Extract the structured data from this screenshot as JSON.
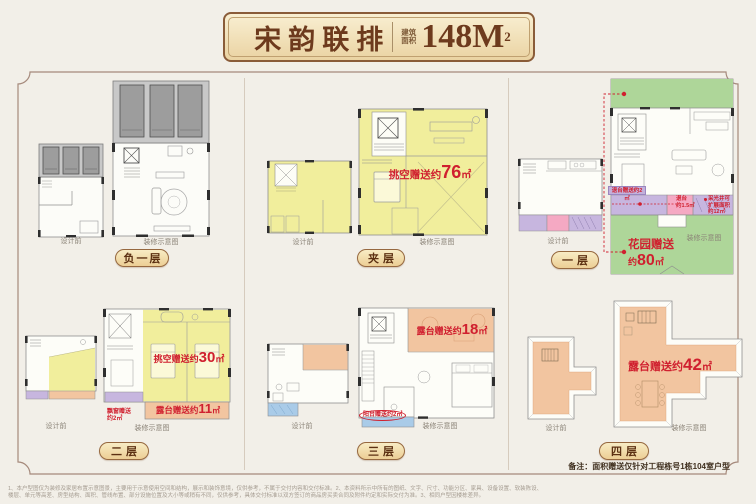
{
  "colors": {
    "background": "#f2efe8",
    "accent_red": "#d0202f",
    "badge_gold": "#ecce95",
    "badge_border": "#96683f",
    "frame_border": "#a5897b",
    "yellow_area": "#f1ee9c",
    "green_area": "#aed699",
    "orange_area": "#f2c5a0",
    "purple_area": "#c7b6df",
    "pink_area": "#f5a9c3",
    "blue_area": "#a9cbe8"
  },
  "title": {
    "name": "宋韵联排",
    "area_label": "建筑面积",
    "area_number": "148M",
    "area_sup": "2"
  },
  "plan_labels": {
    "before": "设计前",
    "after": "装修示意图"
  },
  "floors": {
    "b1": {
      "name": "负一层"
    },
    "mezz": {
      "name": "夹层",
      "void_gift": {
        "prefix": "挑空赠送约",
        "value": "76",
        "unit": "㎡"
      }
    },
    "f1": {
      "name": "一层",
      "garden_gift": {
        "line1": "花园赠送",
        "prefix2": "约",
        "value": "80",
        "unit": "㎡"
      },
      "setback_banner": "退台赠送约2㎡",
      "setback_box": {
        "line1": "退台",
        "line2": "约1.5㎡"
      },
      "lightwell": {
        "line1": "采光井可",
        "line2": "扩展面积",
        "line3": "约12㎡"
      }
    },
    "f2": {
      "name": "二层",
      "void_gift": {
        "prefix": "挑空赠送约",
        "value": "30",
        "unit": "㎡"
      },
      "terrace_gift": {
        "prefix": "露台赠送约",
        "value": "11",
        "unit": "㎡"
      },
      "bay_gift": {
        "line1": "飘窗赠送",
        "line2": "约2㎡"
      }
    },
    "f3": {
      "name": "三层",
      "terrace_gift": {
        "prefix": "露台赠送约",
        "value": "18",
        "unit": "㎡"
      },
      "balcony_gift": "阳台赠送约2㎡"
    },
    "f4": {
      "name": "四层",
      "terrace_gift": {
        "prefix": "露台赠送约",
        "value": "42",
        "unit": "㎡"
      }
    }
  },
  "note": "备注：面积赠送仅针对工程栋号1栋104室户型",
  "disclaimer": {
    "line1": "1、本户型图仅为装修及家居布置示意图景，主要用于示意使用空间和结构，展示和装饰意境，仅供参考，不属于交付内容和交付标准。2、本资料所示中所有的图纸、文字、尺寸、功能分区、家具、设备设置、软装陈设、",
    "line2": "楼层、单元等高差、房型结构、面积、管线布置、部分设施位置及大小等或稍有不同，仅供参考，具体交付标准以双方签订的商品房买卖合同及附件约定和实际交付为准。3、相同户型因楼栋差异。"
  }
}
